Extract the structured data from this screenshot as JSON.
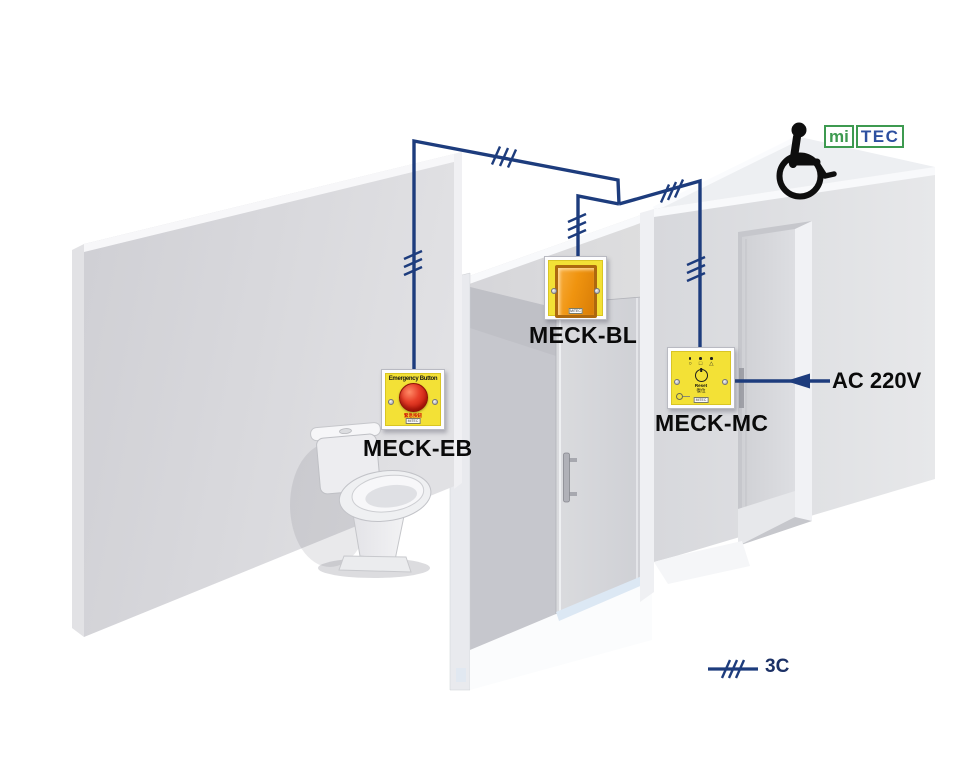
{
  "logo": {
    "mi": "mi",
    "tec": "TEC"
  },
  "devices": {
    "meck_eb": {
      "label": "MECK-EB",
      "plate_title": "Emergency Button",
      "plate_title_zh": "緊急按鈕",
      "brand": "MiTEC"
    },
    "meck_bl": {
      "label": "MECK-BL",
      "brand": "MiTEC"
    },
    "meck_mc": {
      "label": "MECK-MC",
      "indicator_icons": [
        "○",
        "□",
        "△"
      ],
      "reset_label": "Reset",
      "reset_label_zh": "復位",
      "brand": "MiTEC"
    }
  },
  "annotations": {
    "power_source": "AC 220V"
  },
  "legend": {
    "cable_code": "3C"
  },
  "colors": {
    "wire_blue": "#1d3c7d",
    "panel_yellow": "#f3e136",
    "lens_orange": "#ef930f",
    "button_red": "#d92a18",
    "logo_green": "#3d9a50",
    "logo_blue": "#2d50a0"
  }
}
